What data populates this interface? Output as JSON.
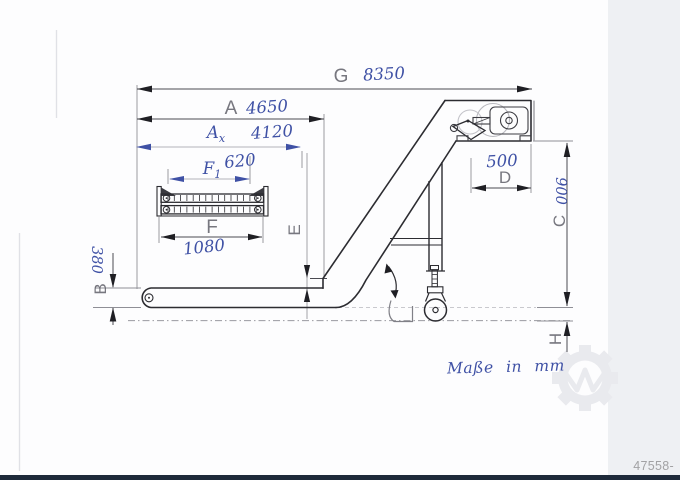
{
  "drawing": {
    "type": "inclined chip conveyor side-view technical drawing",
    "note": "Maße in mm",
    "dimensions": {
      "G": {
        "letter": "G",
        "value": "8350"
      },
      "A": {
        "letter": "A",
        "value": "4650"
      },
      "Ax": {
        "letter": "A",
        "sub": "x",
        "value": "4120"
      },
      "F1": {
        "letter": "F",
        "sub": "1",
        "value": "620"
      },
      "F": {
        "letter": "F",
        "value": "1080"
      },
      "D": {
        "letter": "D",
        "value": "500"
      },
      "B": {
        "letter": "B",
        "value": "380"
      },
      "C": {
        "letter": "C",
        "value": "900"
      },
      "E": {
        "letter": "E",
        "value": ""
      },
      "H": {
        "letter": "H",
        "value": ""
      }
    }
  },
  "footer": {
    "listing_number": "47558-17678748"
  },
  "colors": {
    "ink_blue": "#3f51a5",
    "line_dark": "#2c2c31",
    "letter_gray": "#5a5a64",
    "footer_bar": "#1e2a3a"
  }
}
